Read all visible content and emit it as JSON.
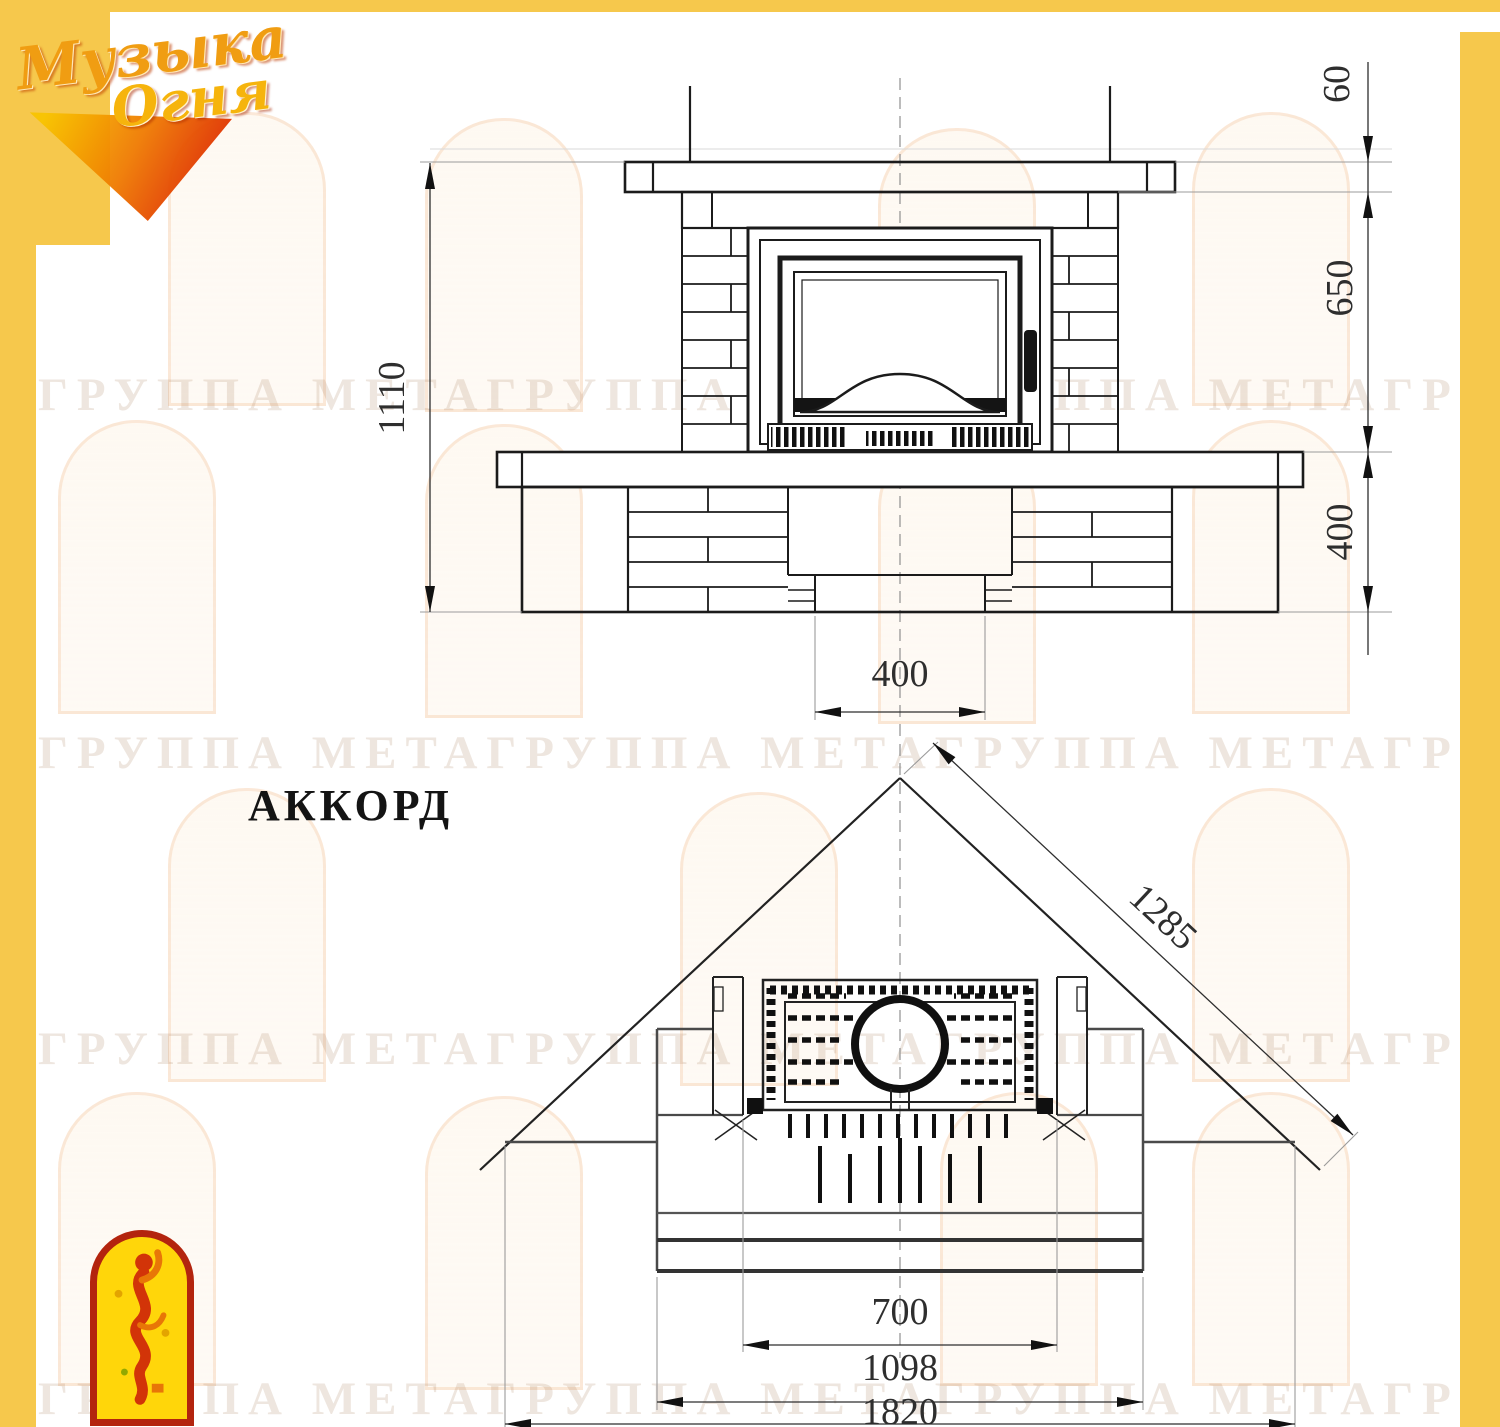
{
  "brand": {
    "logo_line1": "Музыка",
    "logo_line2": "Огня"
  },
  "model_title": "АККОРД",
  "watermark_text": "ГРУППА МЕТАГРУППА МЕТАГРУППА МЕТАГРУППА МЕТА",
  "colors": {
    "frame_yellow": "#F6C84C",
    "drawing_line": "#1B1B1B",
    "logo_orange": "#F09D12",
    "emblem_red": "#B3240E",
    "emblem_yellow": "#FFD60A"
  },
  "front_view": {
    "dim_total_height": "1110",
    "dim_shelf_thickness": "60",
    "dim_opening_height": "650",
    "dim_base_height": "400",
    "dim_recess_width": "400"
  },
  "plan_view": {
    "dim_diagonal_depth": "1285",
    "dim_firebox_width": "700",
    "dim_body_width": "1098",
    "dim_overall_width": "1820"
  }
}
